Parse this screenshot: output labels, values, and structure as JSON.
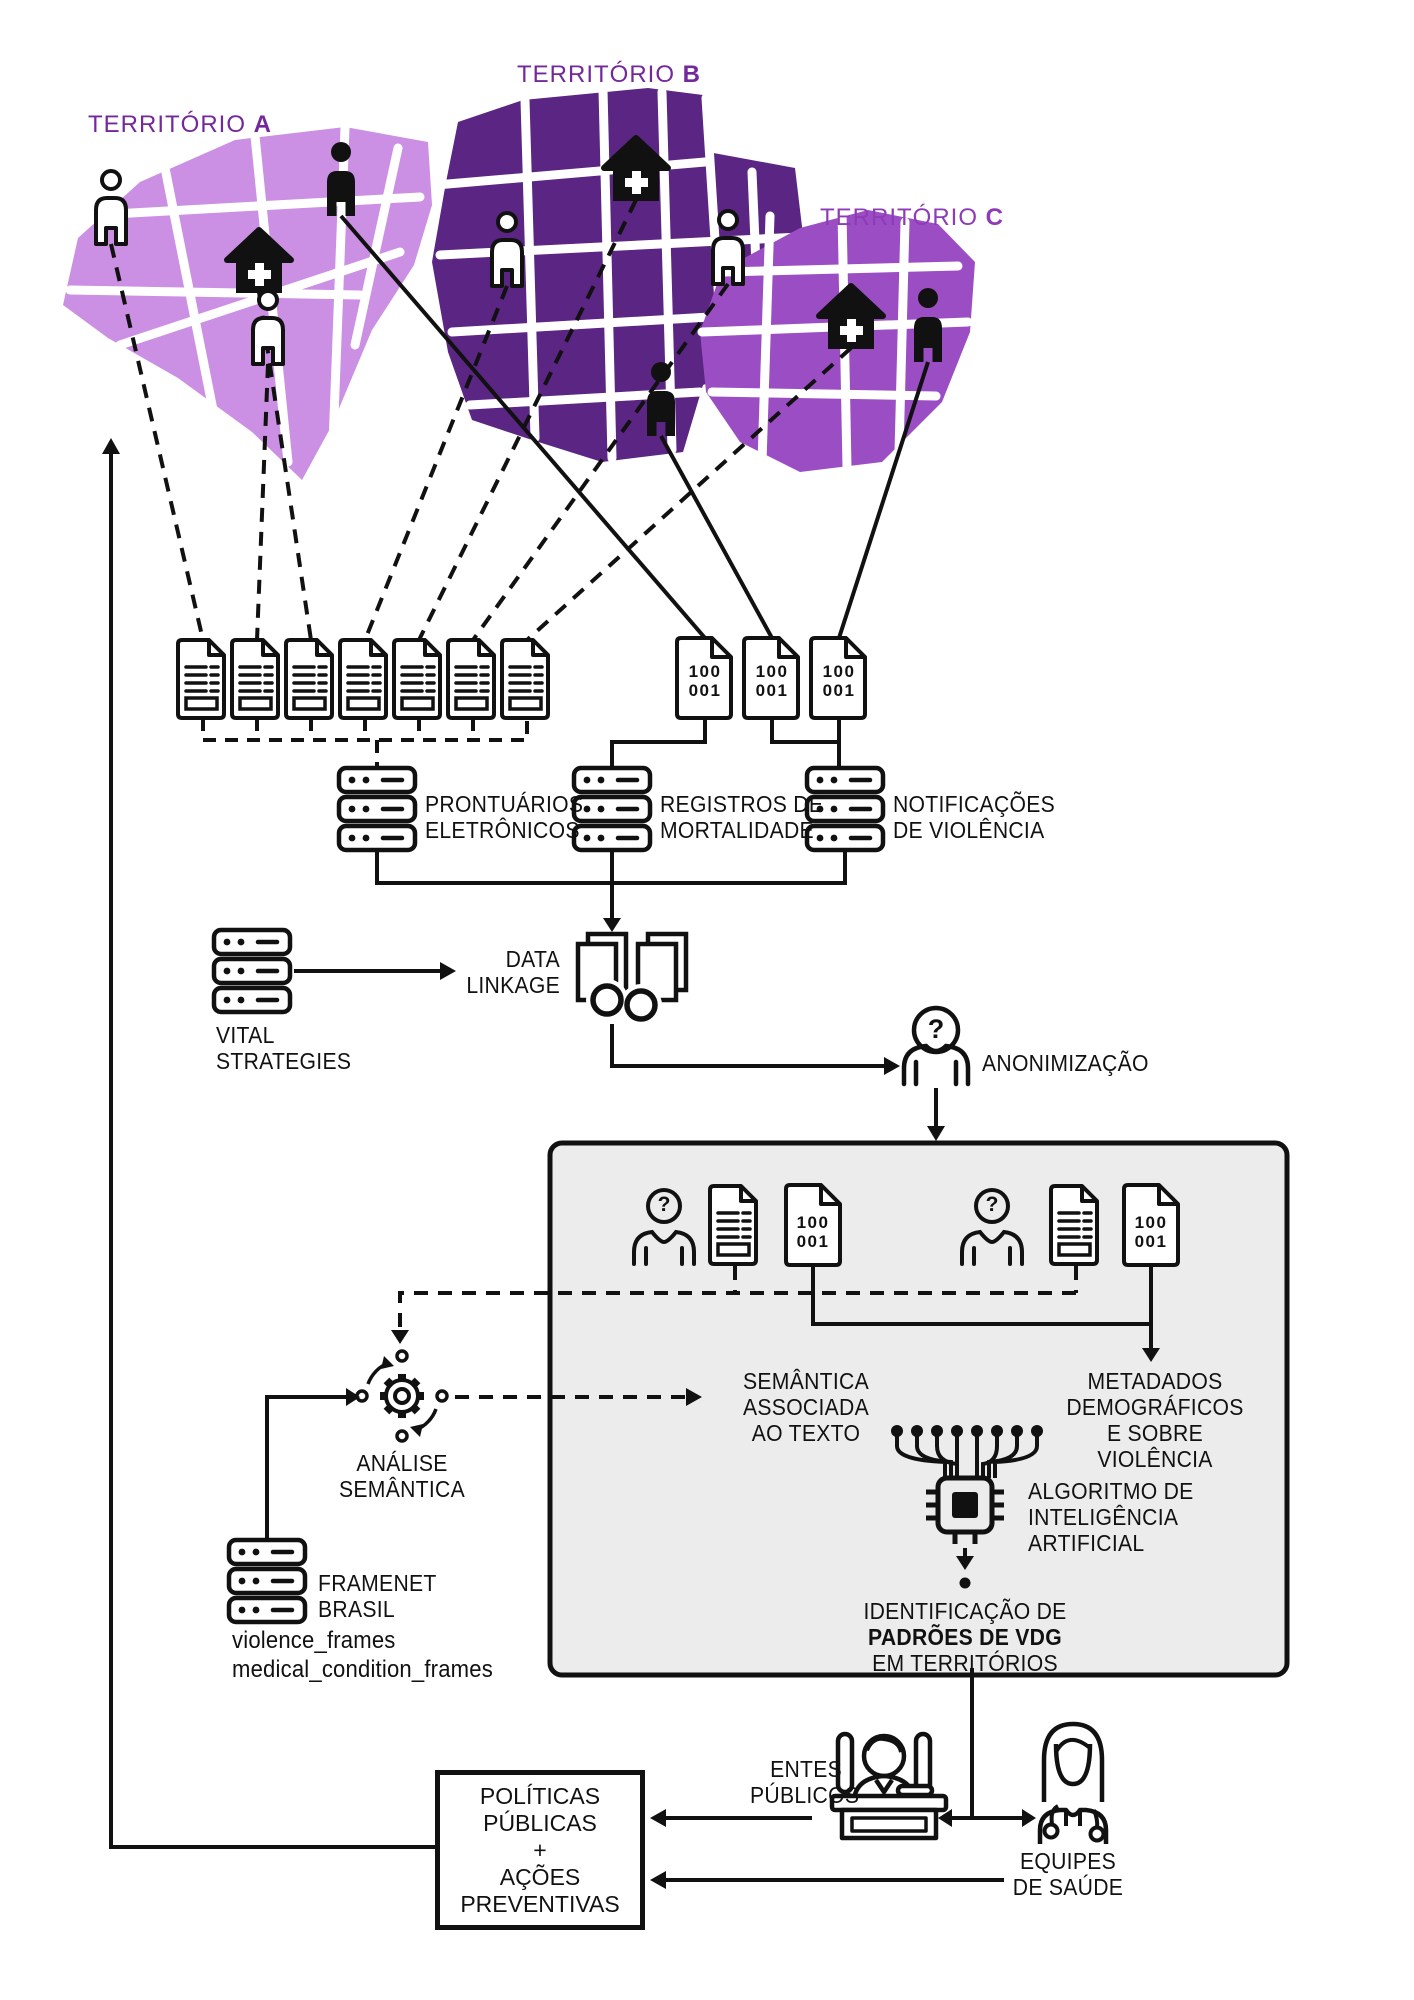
{
  "glyphs": {
    "question": "?"
  },
  "territory_labels": [
    {
      "name": "TERRITÓRIO",
      "letter": "A"
    },
    {
      "name": "TERRITÓRIO",
      "letter": "B"
    },
    {
      "name": "TERRITÓRIO",
      "letter": "C"
    }
  ],
  "binary_doc": "100\n001",
  "sources": {
    "prontuarios": "PRONTUÁRIOS\nELETRÔNICOS",
    "registros": "REGISTROS DE\nMORTALIDADE",
    "notificacoes": "NOTIFICAÇÕES\nDE VIOLÊNCIA"
  },
  "vital_strategies": "VITAL\nSTRATEGIES",
  "data_linkage": "DATA\nLINKAGE",
  "anonimizacao": "ANONIMIZAÇÃO",
  "analise_semantica": "ANÁLISE\nSEMÂNTICA",
  "framenet": "FRAMENET\nBRASIL",
  "framenet_frames": "violence_frames\nmedical_condition_frames",
  "box_labels": {
    "semantica_texto": "SEMÂNTICA\nASSOCIADA\nAO TEXTO",
    "metadados": "METADADOS\nDEMOGRÁFICOS\nE SOBRE\nVIOLÊNCIA",
    "algoritmo": "ALGORITMO DE\nINTELIGÊNCIA\nARTIFICIAL",
    "identificacao_pre": "IDENTIFICAÇÃO DE",
    "identificacao_bold": "PADRÕES DE VDG",
    "identificacao_post": "EM TERRITÓRIOS"
  },
  "outcomes": {
    "entes_publicos": "ENTES\nPÚBLICOS",
    "equipes_saude": "EQUIPES\nDE SAÚDE",
    "politicas": "POLÍTICAS\nPÚBLICAS\n+\nAÇÕES\nPREVENTIVAS"
  },
  "colors": {
    "territory_a": "#cb8fe4",
    "territory_b": "#5b2583",
    "territory_c": "#9b4ec4",
    "label_ab": "#73289b",
    "label_c": "#8f3ab6",
    "ink": "#111111",
    "box_fill": "#ececec"
  }
}
